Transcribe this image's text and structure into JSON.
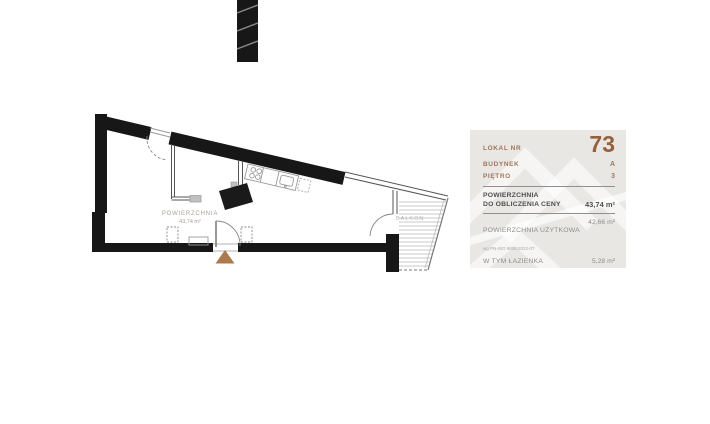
{
  "plan": {
    "area_label": "POWIERZCHNIA",
    "area_value": "43,74 m²",
    "balcony_label": "BALKON"
  },
  "panel": {
    "unit_label": "LOKAL NR",
    "unit_number": "73",
    "building_label": "BUDYNEK",
    "building_value": "A",
    "floor_label": "PIĘTRO",
    "floor_value": "3",
    "price_area_label_line1": "POWIERZCHNIA",
    "price_area_label_line2": "DO OBLICZENIA CENY",
    "price_area_value": "43,74 m²",
    "usable_area_label": "POWIERZCHNIA UŻYTKOWA",
    "usable_area_norm": "wg PN-ISO 9836:2022-07",
    "usable_area_value": "42,66 m²",
    "bathroom_label": "W TYM ŁAZIENKA",
    "bathroom_value": "5,28 m²",
    "balcony_label": "BALKON",
    "balcony_value": ""
  },
  "colors": {
    "accent_brown": "#a1765a",
    "number_brown": "#96613c",
    "panel_bg": "#e8e7e4",
    "dark_text": "#4f4f4f",
    "gray_text": "#8d8d8d",
    "wall_black": "#171717",
    "triangle_tan": "#ab7a4e"
  }
}
